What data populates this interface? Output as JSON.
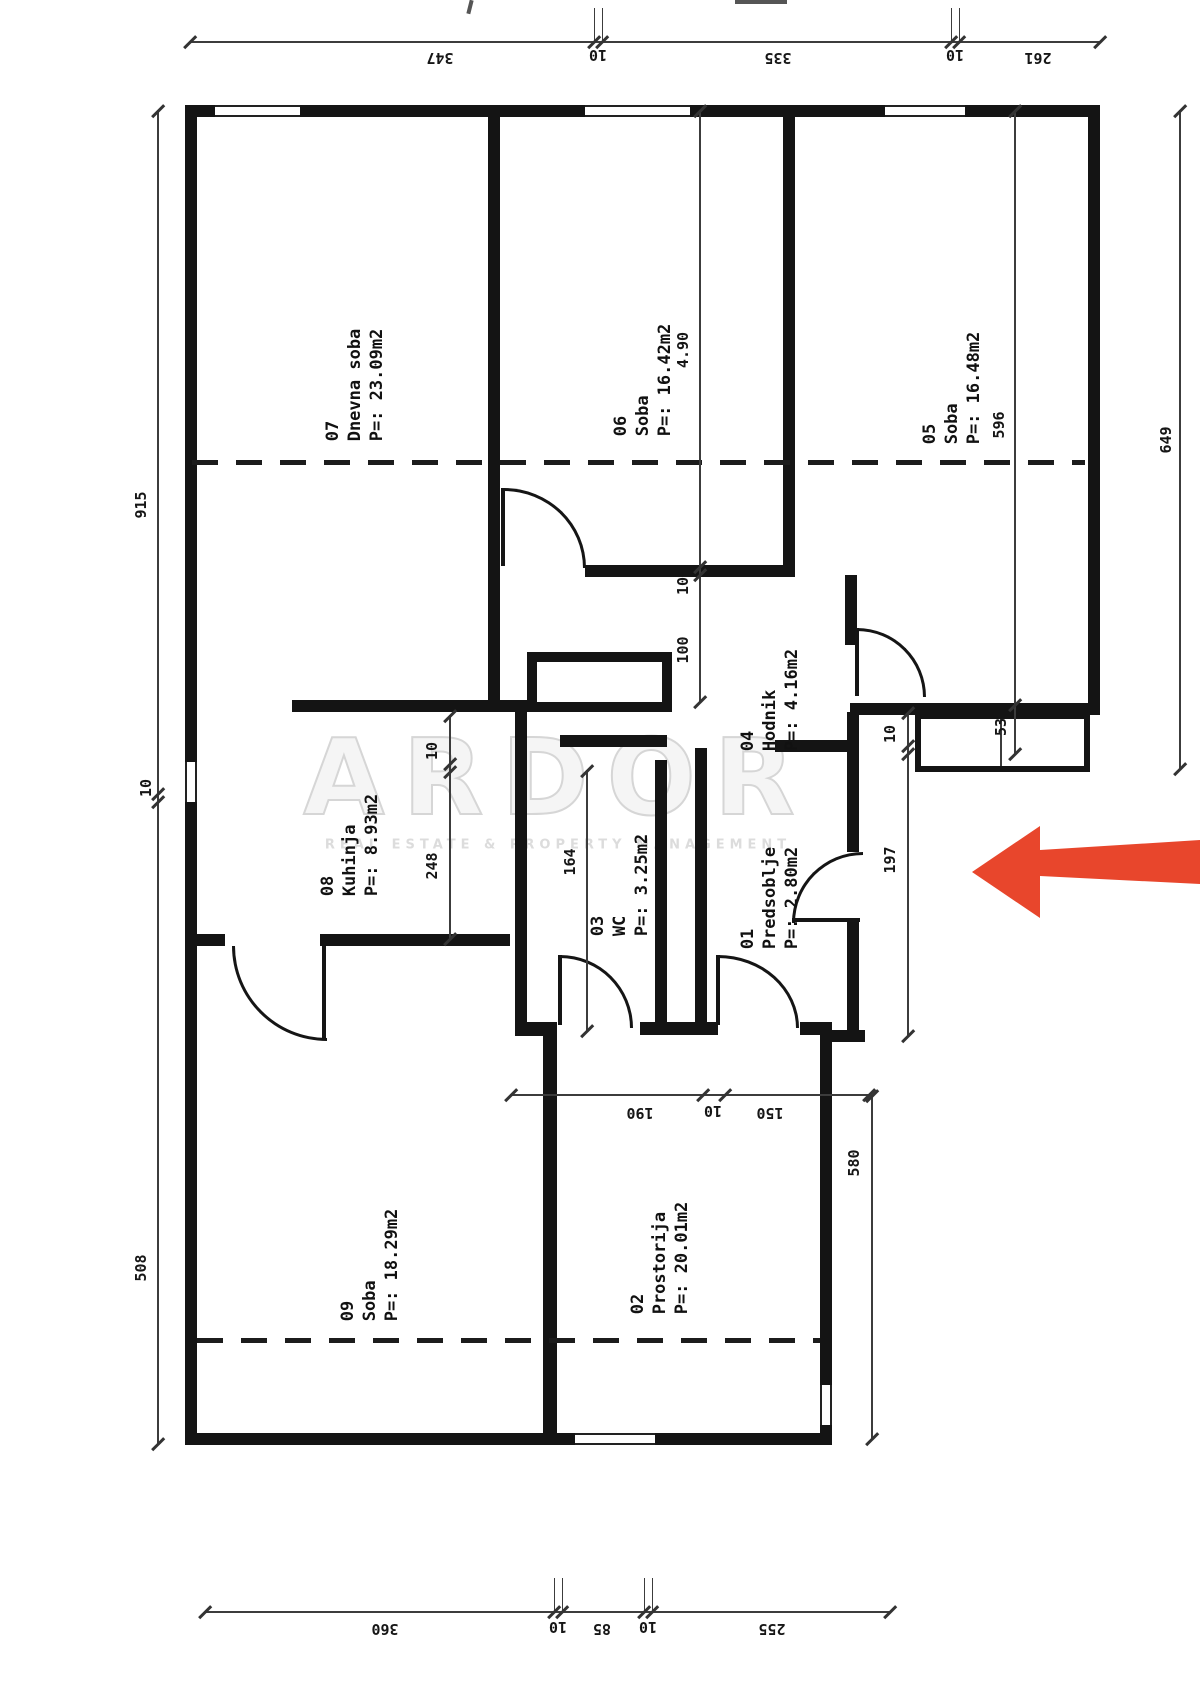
{
  "plan": {
    "watermark": {
      "brand": "ARDOR",
      "tagline": "REAL ESTATE & PROPERTY MANAGEMENT"
    },
    "arrow_color": "#e8462c",
    "rooms": [
      {
        "id": "07",
        "name": "Dnevna soba",
        "area": "P=: 23.09m2"
      },
      {
        "id": "06",
        "name": "Soba",
        "area": "P=: 16.42m2"
      },
      {
        "id": "05",
        "name": "Soba",
        "area": "P=: 16.48m2"
      },
      {
        "id": "04",
        "name": "Hodnik",
        "area": "P=: 4.16m2"
      },
      {
        "id": "08",
        "name": "Kuhinja",
        "area": "P=: 8.93m2"
      },
      {
        "id": "03",
        "name": "WC",
        "area": "P=: 3.25m2"
      },
      {
        "id": "01",
        "name": "Predsoblje",
        "area": "P=: 2.80m2"
      },
      {
        "id": "09",
        "name": "Soba",
        "area": "P=: 18.29m2"
      },
      {
        "id": "02",
        "name": "Prostorija",
        "area": "P=: 20.01m2"
      }
    ],
    "dims": {
      "top": [
        "347",
        "10",
        "335",
        "10",
        "261"
      ],
      "bottom": [
        "360",
        "10",
        "85",
        "10",
        "255"
      ],
      "left": [
        "915",
        "10",
        "508"
      ],
      "right": "649",
      "room05_inner": [
        "596",
        "53"
      ],
      "room06_inner": [
        "4.90",
        "10",
        "100"
      ],
      "kitchen": [
        "10",
        "248"
      ],
      "wc": "164",
      "predsoblje": [
        "10",
        "197"
      ],
      "room02": "580",
      "hall_line": [
        "190",
        "10",
        "150"
      ]
    }
  }
}
